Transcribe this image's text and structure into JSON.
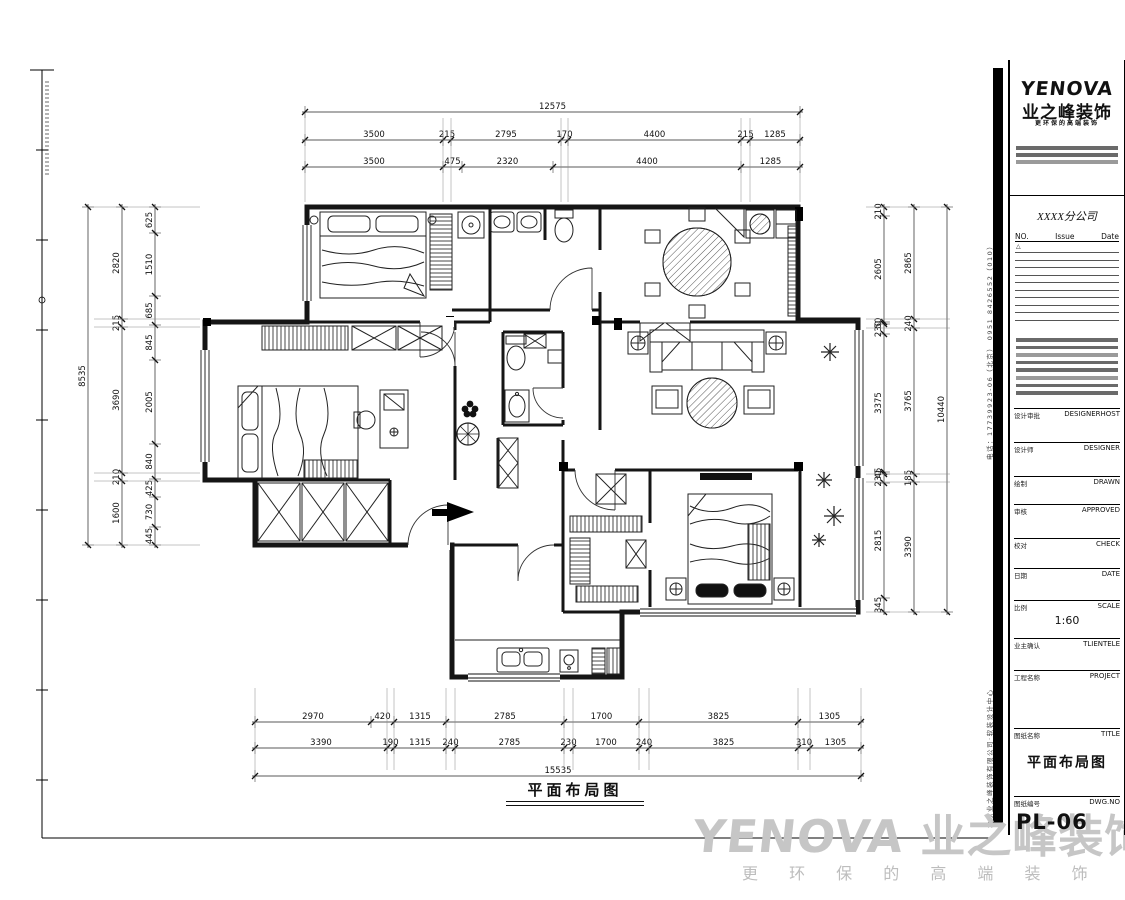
{
  "sheet": {
    "caption": "平面布局图",
    "watermark": {
      "logo": "YENOVA",
      "brand": "业之峰装饰",
      "tagline": "更 环 保 的 高 端 装 饰"
    }
  },
  "titleblock": {
    "logo": "YENOVA",
    "brand": "业之峰装饰",
    "tagline": "更环保的高端装饰",
    "branch": "XXXX分公司",
    "rev_header": {
      "no": "NO.",
      "issue": "Issue",
      "date": "Date"
    },
    "rev_symbol": "△",
    "rows": [
      {
        "cn": "设计审批",
        "en": "DESIGNERHOST"
      },
      {
        "cn": "设计师",
        "en": "DESIGNER"
      },
      {
        "cn": "绘制",
        "en": "DRAWN"
      },
      {
        "cn": "审核",
        "en": "APPROVED"
      },
      {
        "cn": "校对",
        "en": "CHECK"
      },
      {
        "cn": "日期",
        "en": "DATE"
      },
      {
        "cn": "比例",
        "en": "SCALE",
        "value": "1:60"
      },
      {
        "cn": "业主确认",
        "en": "TLIENTELE"
      },
      {
        "cn": "工程名称",
        "en": "PROJECT"
      },
      {
        "cn": "图纸名称",
        "en": "TITLE",
        "value": "平面布局图"
      },
      {
        "cn": "图纸编号",
        "en": "DWG.NO",
        "value": "PL-06"
      }
    ],
    "side_note_top": "电话：17739923-06（北京）  0951 8426552（010）",
    "side_note_bottom": "北京业之峰装饰有限公司·软装设计中心"
  },
  "dimensions": {
    "top_total": [
      "12575"
    ],
    "top_row1": [
      "3500",
      "215",
      "2795",
      "170",
      "4400",
      "215",
      "1285"
    ],
    "top_row2": [
      "3500",
      "475",
      "2320",
      "4400",
      "1285"
    ],
    "left_total": [
      "8535"
    ],
    "left_mid": [
      "2820",
      "215",
      "3690",
      "210",
      "1600"
    ],
    "left_inner": [
      "625",
      "1510",
      "685",
      "845",
      "2005",
      "840",
      "425",
      "730",
      "445"
    ],
    "right_total": [
      "10440"
    ],
    "right_mid": [
      "2865",
      "240",
      "3765",
      "185",
      "3390"
    ],
    "right_inner": [
      "210",
      "2605",
      "50",
      "230",
      "3375",
      "45",
      "230",
      "2815",
      "345"
    ],
    "bottom_total": [
      "15535"
    ],
    "bottom_row1": [
      "2970",
      "420",
      "1315",
      "2785",
      "1700",
      "3825",
      "1305"
    ],
    "bottom_row2": [
      "3390",
      "190",
      "1315",
      "240",
      "2785",
      "230",
      "1700",
      "240",
      "3825",
      "310",
      "1305"
    ]
  }
}
